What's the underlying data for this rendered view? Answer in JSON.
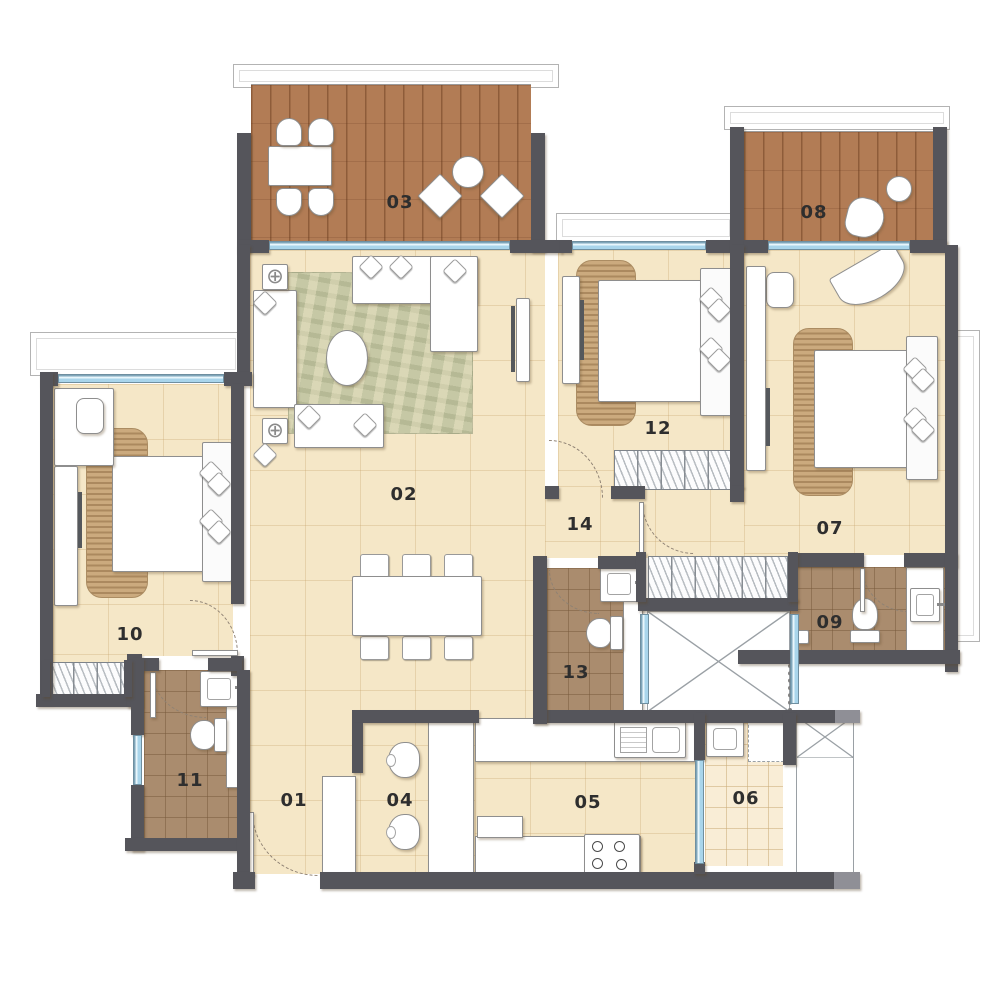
{
  "plan": {
    "title": "Apartment Floor Plan",
    "labels": {
      "entry_foyer": "01",
      "living_dining": "02",
      "living_deck": "03",
      "breakfast_counter": "04",
      "kitchen": "05",
      "utility": "06",
      "bedroom_right": "07",
      "bedroom_deck": "08",
      "bath_right": "09",
      "bedroom_left": "10",
      "bath_left": "11",
      "bedroom_middle": "12",
      "bath_middle": "13",
      "passage": "14"
    },
    "glyphs": {
      "corner_table": "⊕"
    },
    "fixtures": [
      "bed",
      "wardrobe",
      "sofa",
      "coffee-table",
      "dining-table",
      "tv-unit",
      "toilet",
      "washbasin",
      "kitchen-sink",
      "hob",
      "deck-chair",
      "stool",
      "lift-shaft",
      "duct"
    ],
    "colors": {
      "wall": "#55555b",
      "wall_light": "#8f8f96",
      "floor": "#f5e7c7",
      "deck": "#b27c55",
      "bath_tile": "#aa8c6e",
      "util_tile": "#f9edd6",
      "window_glass": "#a9d5eb",
      "window_frame": "#6f8fa0",
      "rug_bed": "#cbaa7e",
      "rug_living": "#c6c8a5",
      "furniture_border": "#8e8e8e",
      "label_text": "#2e2e2e",
      "ledge_border": "#b3b3b3"
    }
  }
}
